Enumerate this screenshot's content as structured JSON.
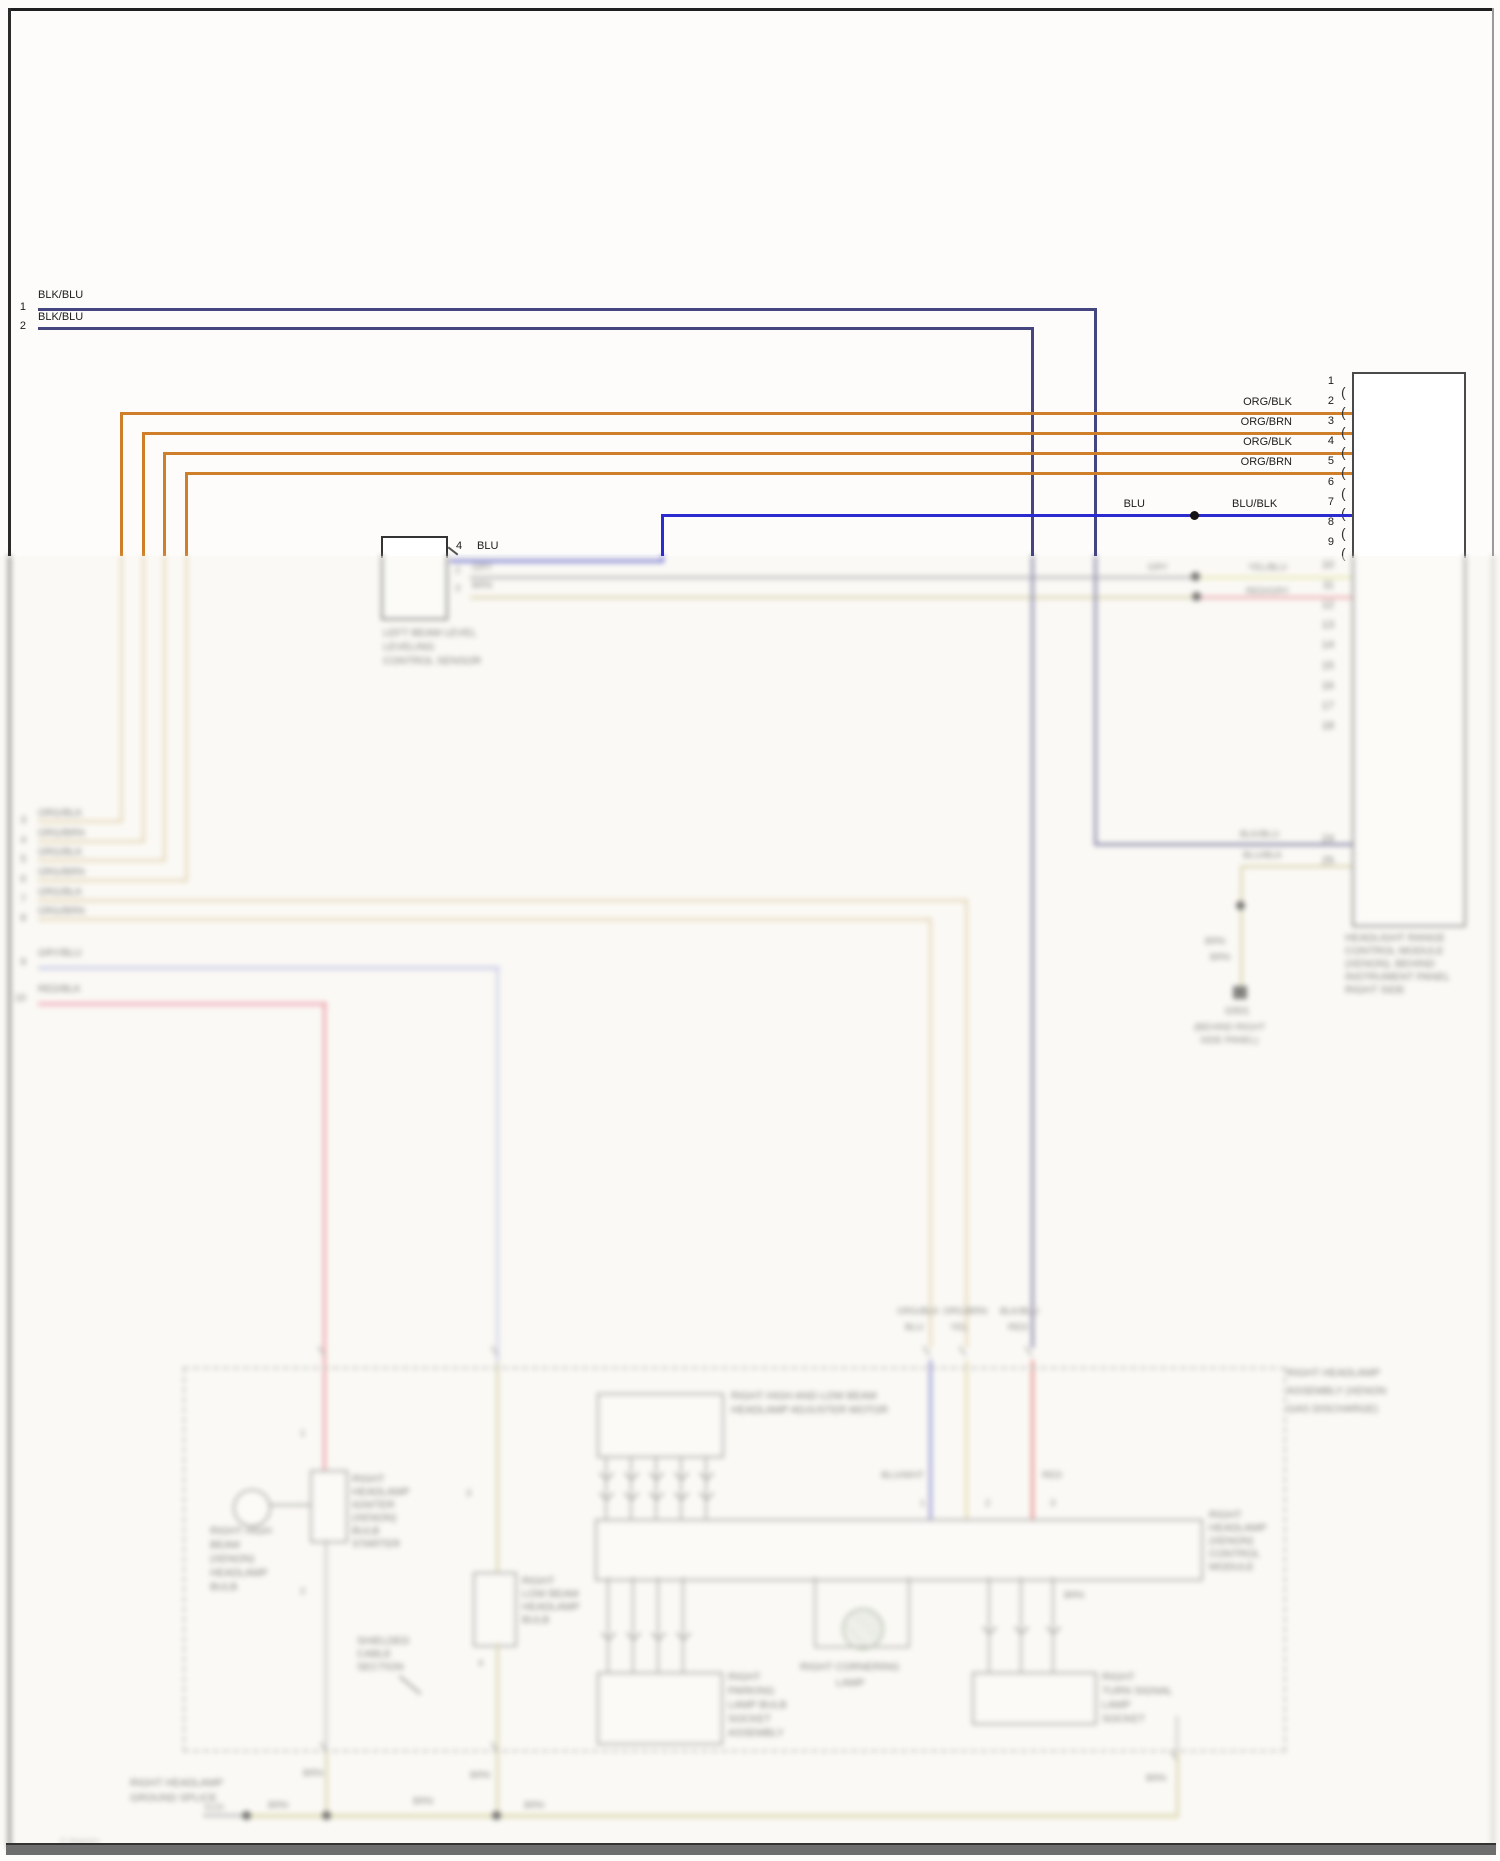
{
  "colors": {
    "navy": "#45457f",
    "blue": "#2b2bd0",
    "orange": "#cf7e29",
    "tan": "#dbc79d",
    "lavender": "#b7bbe8",
    "pink": "#ee8fa6",
    "red": "#d94f4f",
    "gray": "#9a9aa0",
    "olive": "#c9c493",
    "yellowgreen": "#dfe39a",
    "salmon": "#e58794"
  },
  "glyph": {
    "bracket": "("
  },
  "left": {
    "stub1": {
      "n": "1",
      "label": "BLK/BLU"
    },
    "stub2": {
      "n": "2",
      "label": "BLK/BLU"
    },
    "stubs": [
      {
        "n": "3",
        "label": "ORG/BLK"
      },
      {
        "n": "4",
        "label": "ORG/BRN"
      },
      {
        "n": "5",
        "label": "ORG/BLK"
      },
      {
        "n": "6",
        "label": "ORG/BRN"
      },
      {
        "n": "7",
        "label": "ORG/BLK"
      },
      {
        "n": "8",
        "label": "ORG/BRN"
      },
      {
        "n": "9",
        "label": "GRY/BLU"
      },
      {
        "n": "10",
        "label": "RED/BLK"
      }
    ]
  },
  "connector": {
    "pins": [
      "1",
      "2",
      "3",
      "4",
      "5",
      "6",
      "7",
      "8",
      "9"
    ],
    "pins_lower": [
      "10",
      "11",
      "12",
      "13",
      "14",
      "15",
      "16",
      "17",
      "18"
    ],
    "pin24": "24",
    "pin25": "25",
    "wire_labels": [
      "ORG/BLK",
      "ORG/BRN",
      "ORG/BLK",
      "ORG/BRN"
    ],
    "blu": "BLU",
    "blublk": "BLU/BLK",
    "caption": [
      "HEADLIGHT RANGE",
      "CONTROL MODULE",
      "(XENON), BEHIND",
      "INSTRUMENT PANEL",
      "RIGHT SIDE"
    ]
  },
  "level_sensor": {
    "pin": "4",
    "wire": "BLU",
    "pin2": "2",
    "wire2": "GRY",
    "pin3": "3",
    "wire3": "BRN",
    "caption": [
      "LEFT BEAM LEVEL",
      "LEVELING",
      "CONTROL SENSOR"
    ]
  },
  "mid": {
    "gry_left": "GRY",
    "gry_right": "YEL/BLU",
    "red_right": "RED/GRY",
    "w1_above": "BLK/BLU",
    "w1_below": "BLU/BLK",
    "brn": "BRN",
    "ground": {
      "code": "G501",
      "loc1": "(BEHIND RIGHT",
      "loc2": "SIDE PANEL)"
    }
  },
  "headlamp": {
    "caption": [
      "RIGHT HEADLAMP",
      "ASSEMBLY (XENON",
      "GAS DISCHARGE)"
    ],
    "entry_labels": [
      {
        "a": "ORG/BLK",
        "b": "BLU"
      },
      {
        "a": "ORG/BRN",
        "b": "YEL"
      },
      {
        "a": "BLK/BLU",
        "b": "RED"
      }
    ],
    "adj": {
      "caption": [
        "RIGHT HIGH AND LOW BEAM",
        "HEADLAMP ADJUSTER MOTOR"
      ]
    },
    "ctrl": {
      "caption": [
        "RIGHT",
        "HEADLAMP",
        "(XENON)",
        "CONTROL",
        "MODULE"
      ],
      "lbl_a": "BLU/WHT",
      "lbl_b": "RED",
      "pin_a": "1",
      "pin_b": "2",
      "pin_c": "3"
    },
    "bulb": {
      "caption": [
        "RIGHT HIGH",
        "BEAM",
        "(XENON)",
        "HEADLAMP",
        "BULB"
      ]
    },
    "igniter": {
      "pin_top": "1",
      "pin_bot": "2",
      "caption": [
        "RIGHT",
        "HEADLAMP",
        "IGNITER",
        "(XENON)",
        "BULB",
        "STARTER"
      ]
    },
    "bulb2": {
      "pin_top": "3",
      "pin_bot": "4",
      "caption": [
        "RIGHT",
        "LOW BEAM",
        "HEADLAMP",
        "BULB"
      ]
    },
    "note": {
      "caption": [
        "SHIELDED",
        "CABLE",
        "SECTION"
      ]
    },
    "lowleft": {
      "caption": [
        "RIGHT",
        "PARKING",
        "LAMP BULB",
        "SOCKET",
        "ASSEMBLY"
      ]
    },
    "lowright": {
      "caption": [
        "RIGHT",
        "TURN SIGNAL",
        "LAMP",
        "SOCKET"
      ]
    },
    "corner": {
      "caption": [
        "RIGHT CORNERING",
        "LAMP"
      ]
    }
  },
  "ground_bus": {
    "left_caption": [
      "RIGHT HEADLAMP",
      "GROUND SPLICE"
    ],
    "s_label": "S120",
    "brn": "BRN"
  },
  "watermark": "© diagram"
}
